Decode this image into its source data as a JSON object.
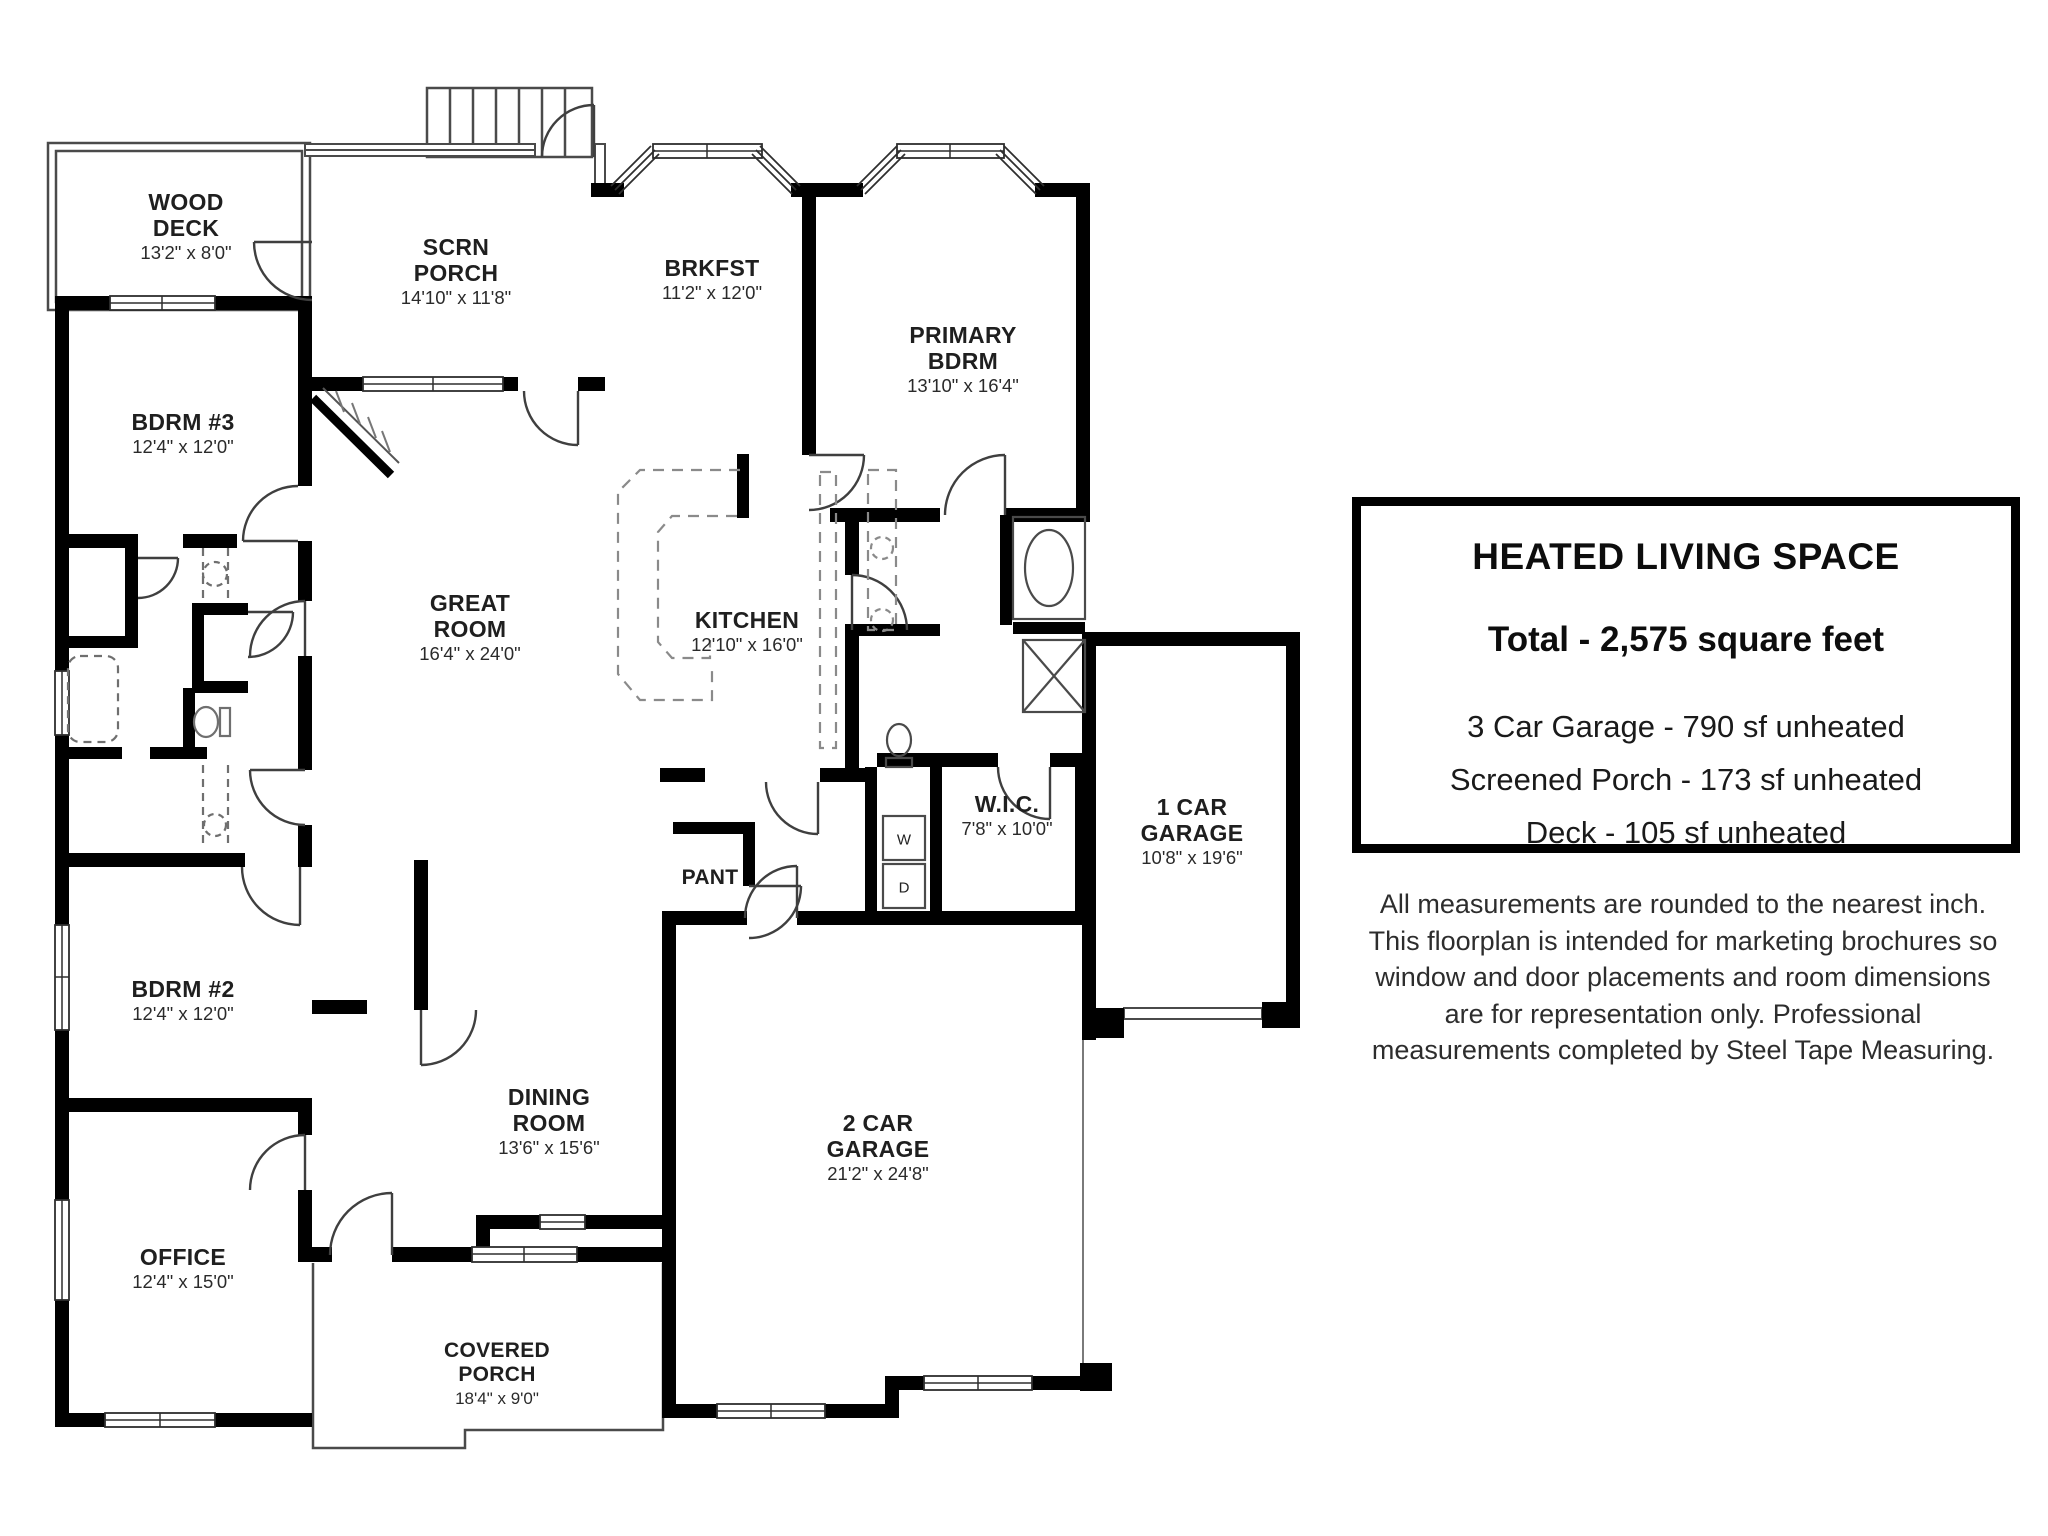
{
  "rooms": {
    "wood_deck": {
      "line1": "WOOD",
      "line2": "DECK",
      "dims": "13'2\" x 8'0\""
    },
    "scrn_porch": {
      "line1": "SCRN",
      "line2": "PORCH",
      "dims": "14'10\" x 11'8\""
    },
    "brkfst": {
      "line1": "BRKFST",
      "dims": "11'2\" x 12'0\""
    },
    "primary_bdrm": {
      "line1": "PRIMARY",
      "line2": "BDRM",
      "dims": "13'10\" x 16'4\""
    },
    "bdrm3": {
      "line1": "BDRM #3",
      "dims": "12'4\" x 12'0\""
    },
    "great_room": {
      "line1": "GREAT",
      "line2": "ROOM",
      "dims": "16'4\" x 24'0\""
    },
    "kitchen": {
      "line1": "KITCHEN",
      "dims": "12'10\" x 16'0\""
    },
    "wic": {
      "line1": "W.I.C.",
      "dims": "7'8\" x 10'0\""
    },
    "garage1": {
      "line1": "1 CAR",
      "line2": "GARAGE",
      "dims": "10'8\" x 19'6\""
    },
    "pantry": {
      "line1": "PANT"
    },
    "bdrm2": {
      "line1": "BDRM #2",
      "dims": "12'4\" x 12'0\""
    },
    "dining": {
      "line1": "DINING",
      "line2": "ROOM",
      "dims": "13'6\" x 15'6\""
    },
    "office": {
      "line1": "OFFICE",
      "dims": "12'4\" x 15'0\""
    },
    "covered_porch": {
      "line1": "COVERED",
      "line2": "PORCH",
      "dims": "18'4\" x 9'0\""
    },
    "garage2": {
      "line1": "2 CAR",
      "line2": "GARAGE",
      "dims": "21'2\" x 24'8\""
    }
  },
  "laundry": {
    "washer": "W",
    "dryer": "D"
  },
  "info": {
    "title": "HEATED LIVING SPACE",
    "total": "Total - 2,575 square feet",
    "items": [
      "3 Car Garage - 790 sf unheated",
      "Screened Porch - 173 sf unheated",
      "Deck - 105 sf unheated"
    ]
  },
  "disclaimer": {
    "line1": "All measurements are rounded to the nearest inch.",
    "line2": "This floorplan is intended for marketing brochures so",
    "line3": "window and door placements and room dimensions",
    "line4": "are for representation only. Professional",
    "line5": "measurements completed by Steel Tape Measuring."
  },
  "colors": {
    "wall": "#000000",
    "thin_line": "#3f3f3f",
    "dashed": "#8a8a8a",
    "text": "#1f1f1f"
  }
}
